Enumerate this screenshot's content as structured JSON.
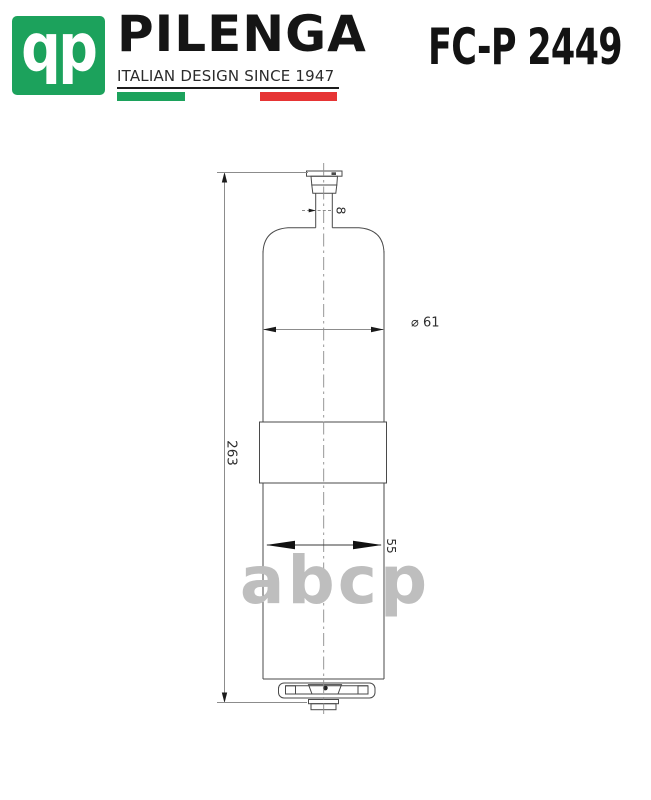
{
  "header": {
    "logo_monogram": "qp",
    "brand": "PILENGA",
    "tagline": "ITALIAN DESIGN SINCE 1947",
    "part_number": "FC-P 2449",
    "colors": {
      "logo_green": "#1CA25C",
      "flag_red": "#E63434",
      "text_black": "#141414"
    }
  },
  "drawing": {
    "subject": "fuel filter outline drawing",
    "dimensions": {
      "overall_height_label": "263",
      "body_diameter_label": "⌀ 61",
      "lower_body_width_label": "55",
      "inlet_tube_label": "8"
    },
    "watermark": "abcp",
    "colors": {
      "outline": "#4A4A4A",
      "dimension_line": "#8C8C8C",
      "dimension_text": "#2E2E2E",
      "watermark_gray": "#BEBEBE"
    }
  }
}
